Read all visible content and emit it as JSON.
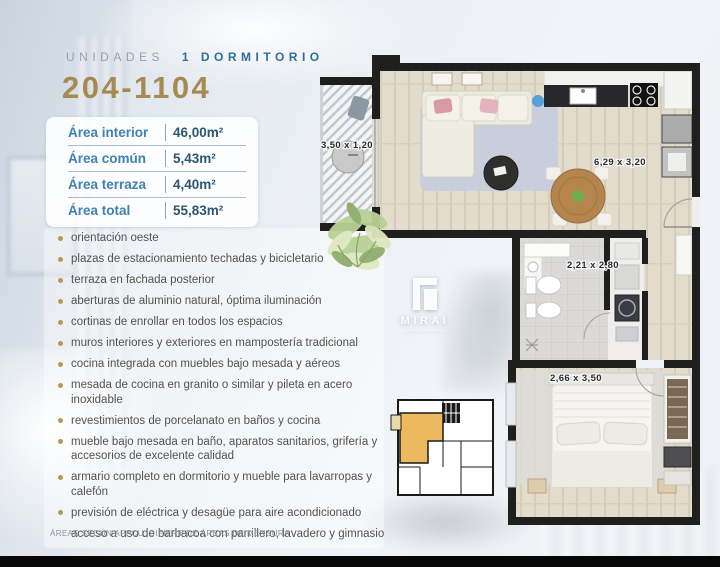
{
  "header": {
    "series_label": "UNIDADES",
    "type_label": "1 DORMITORIO",
    "unit_range": "204-1104"
  },
  "area_table": {
    "rows": [
      {
        "label": "Área interior",
        "value": "46,00m²"
      },
      {
        "label": "Área común",
        "value": "5,43m²"
      },
      {
        "label": "Área terraza",
        "value": "4,40m²"
      },
      {
        "label": "Área total",
        "value": "55,83m²"
      }
    ]
  },
  "features": [
    {
      "text": "orientación oeste",
      "bullet": true
    },
    {
      "text": "plazas de estacionamiento techadas y bicicletario",
      "bullet": true
    },
    {
      "text": "terraza en fachada posterior",
      "bullet": true
    },
    {
      "text": "aberturas de aluminio natural, óptima iluminación",
      "bullet": true
    },
    {
      "text": "cortinas de enrollar en todos los espacios",
      "bullet": true
    },
    {
      "text": "muros interiores y exteriores en mampostería tradicional",
      "bullet": true
    },
    {
      "text": "cocina integrada con muebles bajo mesada y aéreos",
      "bullet": true
    },
    {
      "text": "mesada de cocina en granito o similar y pileta en acero\ninoxidable",
      "bullet": true
    },
    {
      "text": "revestimientos de porcelanato en baños y cocina",
      "bullet": true
    },
    {
      "text": "mueble bajo mesada en baño, aparatos sanitarios, grifería y\naccesorios de excelente calidad",
      "bullet": true
    },
    {
      "text": "armario completo en dormitorio y mueble para lavarropas y\ncalefón",
      "bullet": true
    },
    {
      "text": "previsión de eléctrica y desagüe para aire acondicionado",
      "bullet": true
    },
    {
      "text": "acceso a uso de barbacoa con parrillero, lavadero y gimnasio",
      "bullet": false
    }
  ],
  "floor_plan": {
    "dims": {
      "terraza": "3,50 x 1,20",
      "living": "6,29 x 3,20",
      "bano": "2,21 x 2,80",
      "dormitorio": "2,66 x 3,50"
    },
    "brand": "MIRAI"
  },
  "footer": {
    "disclaimer": "ÁREAS SEGÚN APPCU. DIFIERE DE ÁREAS DE MENSURA"
  },
  "colors": {
    "accent_gold": "#a58b51",
    "label_blue": "#3f81b0",
    "value_navy": "#2d566f",
    "type_teal": "#2f6f96",
    "bullet_gold": "#b49a55",
    "unit_highlight": "#edb95e"
  }
}
